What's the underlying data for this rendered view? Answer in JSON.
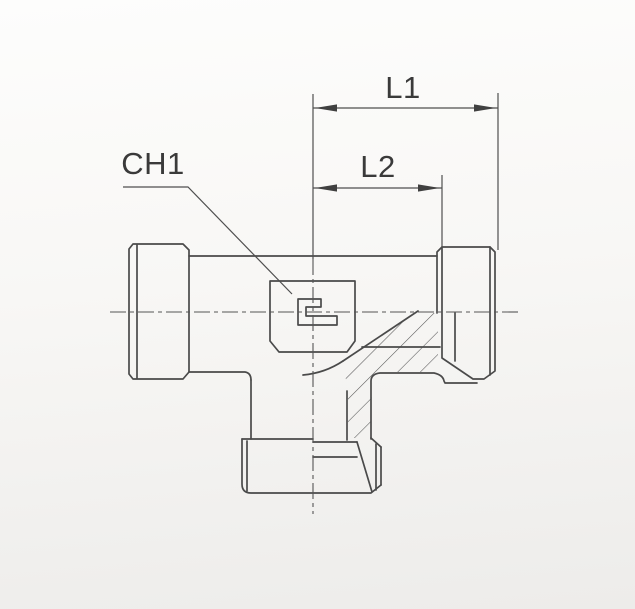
{
  "drawing": {
    "dimension_labels": {
      "l1": "L1",
      "l2": "L2"
    },
    "callout_labels": {
      "ch1": "CH1"
    },
    "colors": {
      "line": "#4a4a4a",
      "text": "#3a3a3a",
      "paper_top": "#fdfdfc",
      "paper_bottom": "#edecea"
    }
  }
}
